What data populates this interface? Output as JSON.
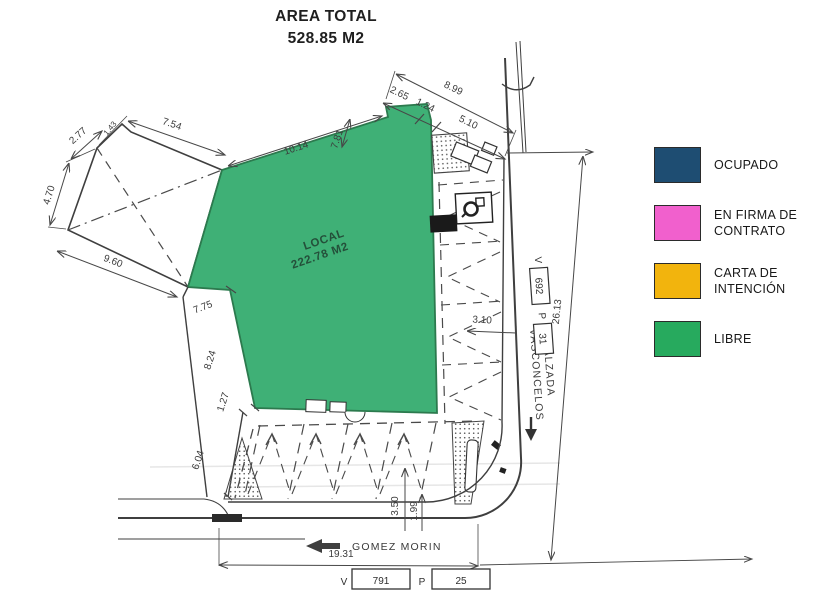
{
  "title": {
    "line1": "AREA TOTAL",
    "line2": "528.85 M2"
  },
  "local": {
    "line1": "LOCAL",
    "line2": "222.78 M2"
  },
  "legend": {
    "items": [
      {
        "label": "OCUPADO",
        "color": "#1e4d72"
      },
      {
        "label": "EN FIRMA DE CONTRATO",
        "color": "#f160cd"
      },
      {
        "label": "CARTA DE INTENCIÓN",
        "color": "#f2b40d"
      },
      {
        "label": "LIBRE",
        "color": "#27aa5e"
      }
    ]
  },
  "streets": {
    "gomez_morin": "GOMEZ MORIN",
    "calzada_line1": "CALZADA",
    "calzada_line2": "VASCONCELOS"
  },
  "cadastre": {
    "right": {
      "v": "V",
      "v_num": "692",
      "p": "P",
      "p_num": "31"
    },
    "bottom": {
      "v": "V",
      "v_num": "791",
      "p": "P",
      "p_num": "25"
    }
  },
  "dims": {
    "d899": "8.99",
    "d265": "2.65",
    "d124": "1.24",
    "d510": "5.10",
    "d754": "7.54",
    "d277": "2.77",
    "d143": "1.43",
    "d470": "4.70",
    "d960": "9.60",
    "d1014": "10.14",
    "d781": "7.81",
    "d775": "7.75",
    "d824": "8.24",
    "d127": "1.27",
    "d604": "6.04",
    "d310": "3.10",
    "d2613": "26.13",
    "d1931": "19.31",
    "d350": "3.50",
    "d199": "1.99"
  },
  "plan_green_fill": "#3fb076"
}
